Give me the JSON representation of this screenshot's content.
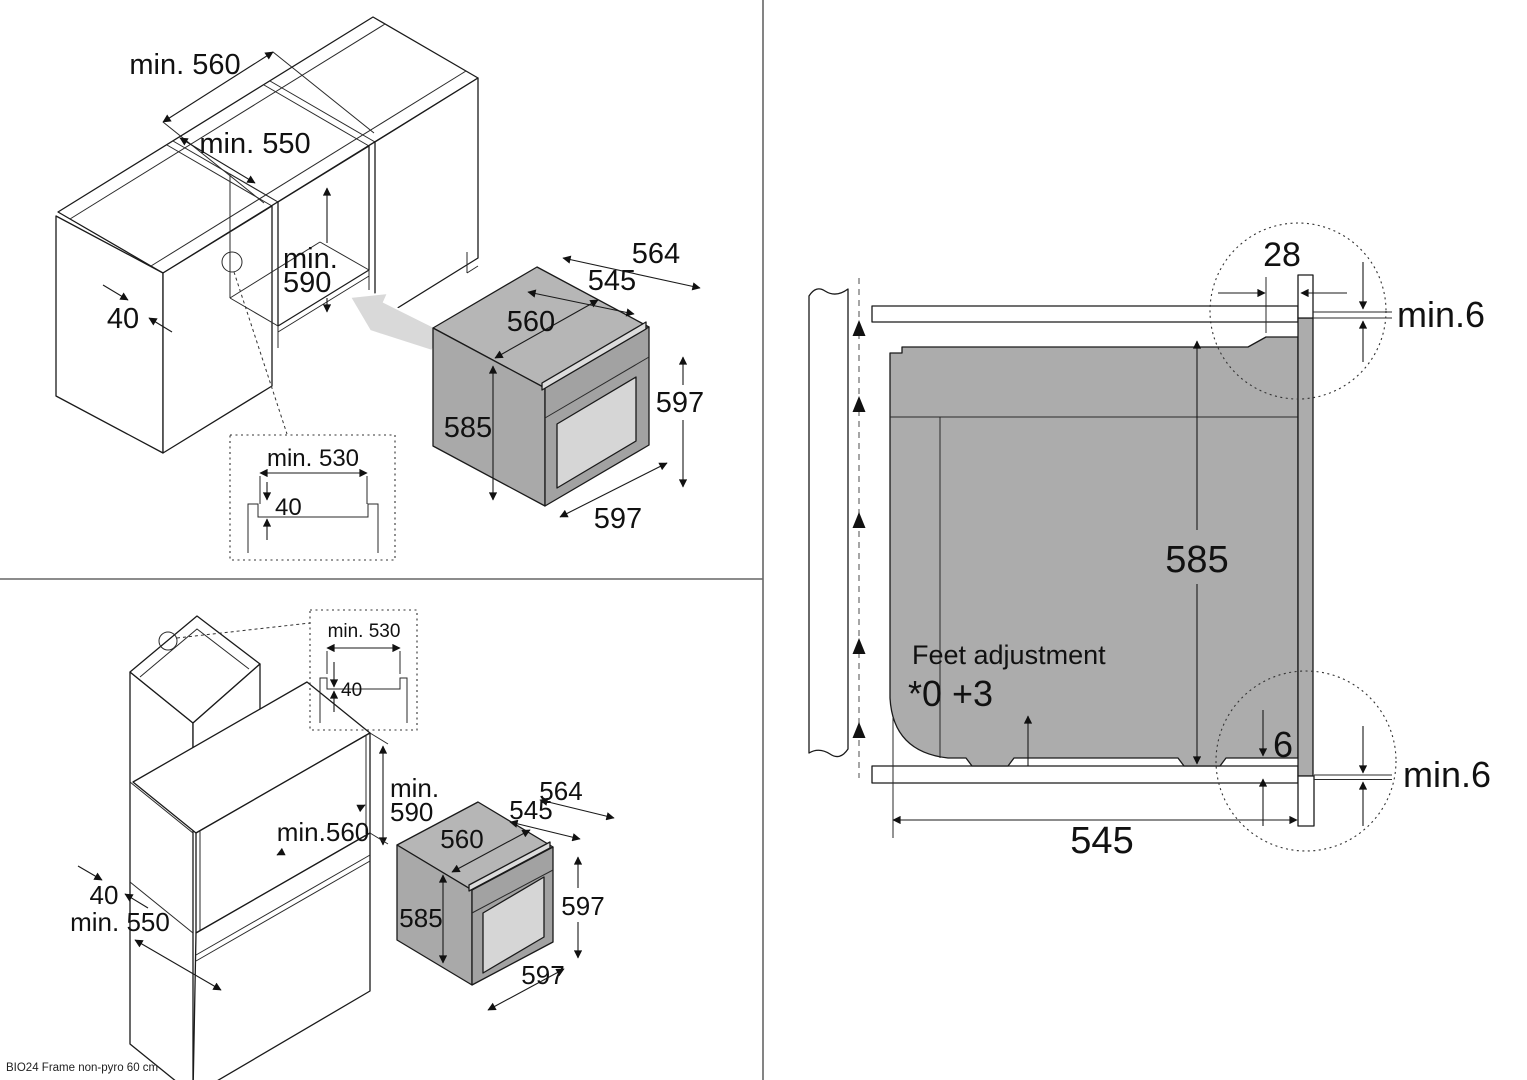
{
  "footer": {
    "note": "BIO24 Frame non-pyro 60 cm"
  },
  "base_view": {
    "min560": "min. 560",
    "min550": "min. 550",
    "min590_l1": "min.",
    "min590_l2": "590",
    "d40": "40",
    "detail": {
      "min530": "min. 530",
      "d40": "40"
    },
    "oven": {
      "d564": "564",
      "d545": "545",
      "d560": "560",
      "d585": "585",
      "d597_side": "597",
      "d597_front": "597"
    }
  },
  "tall_view": {
    "min590_l1": "min.",
    "min590_l2": "590",
    "min560": "min.560",
    "d40": "40",
    "min550": "min. 550",
    "detail": {
      "min530": "min. 530",
      "d40": "40"
    },
    "oven": {
      "d564": "564",
      "d545": "545",
      "d560": "560",
      "d585": "585",
      "d597_side": "597",
      "d597_front": "597"
    }
  },
  "section_view": {
    "d28": "28",
    "min6_top": "min.6",
    "d585": "585",
    "feet_label": "Feet adjustment",
    "feet_range": "*0 +3",
    "d6": "6",
    "min6_bottom": "min.6",
    "d545": "545"
  }
}
